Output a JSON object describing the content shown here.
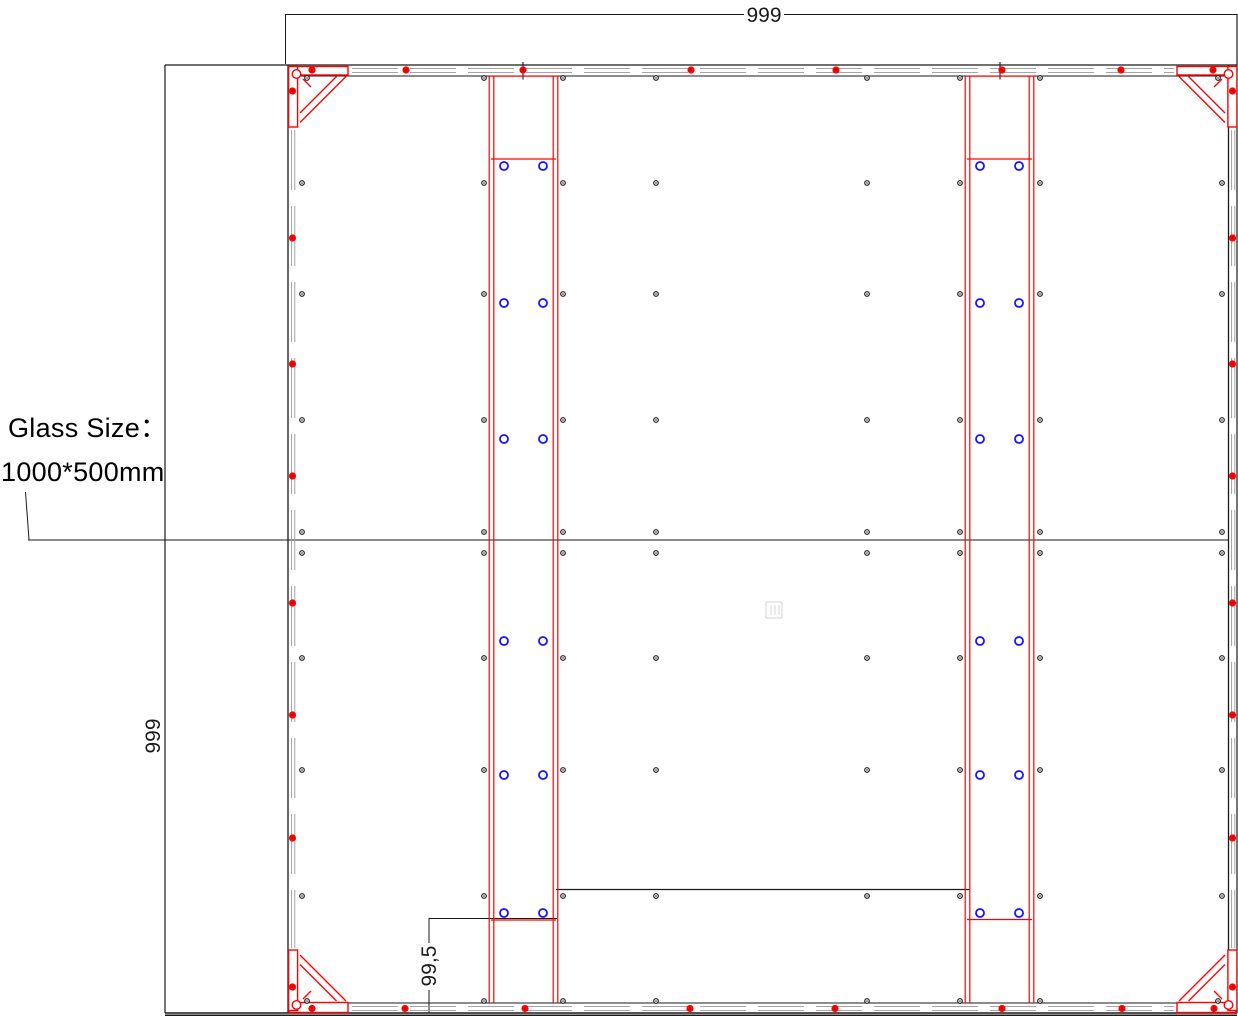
{
  "labels": {
    "glass_size_line1": "Glass Size：",
    "glass_size_line2": "1000*500mm"
  },
  "dimensions": {
    "top": "999",
    "left": "999",
    "bottom": "99,5"
  },
  "colors": {
    "frame_red": "#ff0000",
    "screw_core_red": "#8b0000",
    "hole_blue": "#1414ff",
    "line_black": "#1a1a1a",
    "profile_gray": "#9a9a9a",
    "center_mark_gray": "#d6d6d6",
    "background": "#ffffff"
  },
  "fasteners": {
    "red_screws": {
      "top_row_y": 70,
      "top_xs": [
        312,
        406,
        523,
        691,
        836,
        1002,
        1121,
        1213
      ],
      "bottom_row_y": 1008.5,
      "bottom_xs": [
        312,
        405,
        525,
        690,
        835,
        1002,
        1122,
        1214
      ],
      "left_col_x": 292.5,
      "left_ys": [
        91,
        238,
        364,
        476,
        603,
        715,
        838,
        987
      ],
      "right_col_x": 1232.5,
      "right_ys": [
        91,
        238,
        364,
        476,
        603,
        715,
        838,
        987
      ]
    },
    "black_rivets": {
      "rows": [
        {
          "y": 78,
          "xs": [
            307,
            484,
            563,
            656,
            867,
            960,
            1040,
            1218
          ]
        },
        {
          "y": 183,
          "xs": [
            302,
            484,
            563,
            656,
            867,
            960,
            1040,
            1222
          ]
        },
        {
          "y": 294,
          "xs": [
            302,
            484,
            563,
            656,
            867,
            960,
            1040,
            1222
          ]
        },
        {
          "y": 420,
          "xs": [
            302,
            484,
            563,
            656,
            867,
            960,
            1040,
            1222
          ]
        },
        {
          "y": 532,
          "xs": [
            302,
            484,
            563,
            656,
            867,
            960,
            1040,
            1222
          ]
        },
        {
          "y": 553,
          "xs": [
            302,
            484,
            563,
            656,
            867,
            960,
            1040,
            1222
          ]
        },
        {
          "y": 658,
          "xs": [
            302,
            484,
            563,
            656,
            867,
            960,
            1040,
            1222
          ]
        },
        {
          "y": 770,
          "xs": [
            302,
            484,
            563,
            656,
            867,
            960,
            1040,
            1222
          ]
        },
        {
          "y": 896,
          "xs": [
            302,
            484,
            563,
            656,
            867,
            960,
            1040,
            1222
          ]
        },
        {
          "y": 1001,
          "xs": [
            307,
            484,
            563,
            656,
            867,
            960,
            1040,
            1218
          ]
        }
      ]
    },
    "blue_holes": {
      "row_ys": [
        166,
        303,
        439,
        641,
        775,
        913
      ],
      "left_rail_xs": [
        504,
        543
      ],
      "right_rail_xs": [
        980,
        1019
      ]
    }
  }
}
